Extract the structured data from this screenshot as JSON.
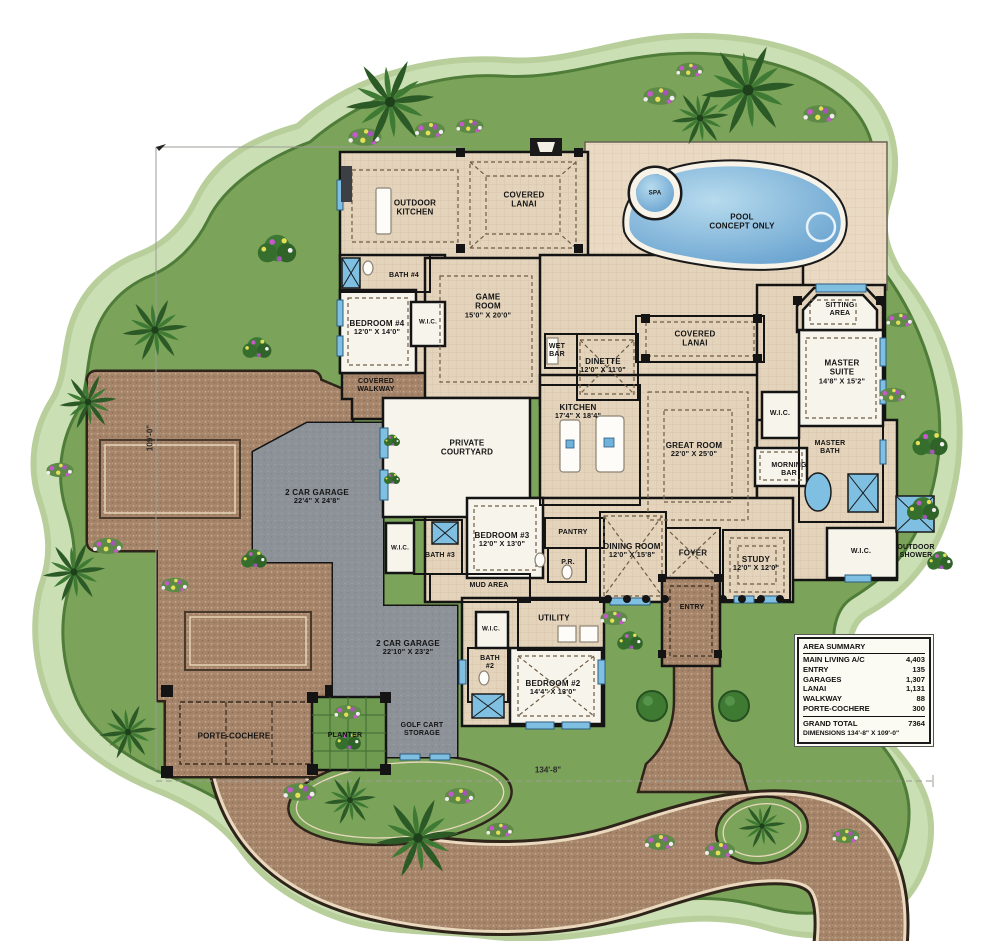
{
  "plan": {
    "type": "luxury-house-floor-plan",
    "colors": {
      "lawn": "#7ba45a",
      "lawn_edge": "#4f7c39",
      "lawn_halo": "#cbdfb4",
      "paver": "#a5846a",
      "room_tan": "#e4d4bc",
      "deck_tan": "#ead9c3",
      "garage_gray": "#8d9298",
      "pool_blue": "#5e9bcb",
      "window_blue": "#7fc0e2",
      "wall": "#141414"
    }
  },
  "rooms": {
    "outdoor_kitchen": {
      "l1": "OUTDOOR",
      "l2": "KITCHEN"
    },
    "covered_lanai_top": {
      "l1": "COVERED",
      "l2": "LANAI"
    },
    "spa": {
      "l1": "SPA"
    },
    "pool": {
      "l1": "POOL",
      "l2": "CONCEPT ONLY"
    },
    "bath4": {
      "l1": "BATH #4"
    },
    "bedroom4": {
      "l1": "BEDROOM #4",
      "dims": "12'0\" X 14'0\""
    },
    "wic4": {
      "l1": "W.I.C."
    },
    "game_room": {
      "l1": "GAME",
      "l2": "ROOM",
      "dims": "15'0\" X 20'0\""
    },
    "wet_bar": {
      "l1": "WET",
      "l2": "BAR"
    },
    "dinette": {
      "l1": "DINETTE",
      "dims": "12'0\" X 11'0\""
    },
    "covered_lanai_mid": {
      "l1": "COVERED",
      "l2": "LANAI"
    },
    "sitting_area": {
      "l1": "SITTING",
      "l2": "AREA"
    },
    "master_suite": {
      "l1": "MASTER",
      "l2": "SUITE",
      "dims": "14'8\" X 15'2\""
    },
    "wic_master": {
      "l1": "W.I.C."
    },
    "master_bath": {
      "l1": "MASTER",
      "l2": "BATH"
    },
    "morning_bar": {
      "l1": "MORNING",
      "l2": "BAR"
    },
    "covered_walkway": {
      "l1": "COVERED",
      "l2": "WALKWAY"
    },
    "kitchen": {
      "l1": "KITCHEN",
      "dims": "17'4\" X 18'4\""
    },
    "courtyard": {
      "l1": "PRIVATE",
      "l2": "COURTYARD"
    },
    "great_room": {
      "l1": "GREAT ROOM",
      "dims": "22'0\" X 25'0\""
    },
    "garage1": {
      "l1": "2 CAR GARAGE",
      "dims": "22'4\" X 24'8\""
    },
    "wic3": {
      "l1": "W.I.C."
    },
    "bath3": {
      "l1": "BATH #3"
    },
    "bedroom3": {
      "l1": "BEDROOM #3",
      "dims": "12'0\" X 13'0\""
    },
    "mud_area": {
      "l1": "MUD AREA"
    },
    "pantry": {
      "l1": "PANTRY"
    },
    "powder": {
      "l1": "P.R."
    },
    "dining": {
      "l1": "DINING ROOM",
      "dims": "12'0\" X 15'8\""
    },
    "foyer": {
      "l1": "FOYER"
    },
    "study": {
      "l1": "STUDY",
      "dims": "12'0\" X 12'0\""
    },
    "wic_master2": {
      "l1": "W.I.C."
    },
    "outdoor_shower": {
      "l1": "OUTDOOR",
      "l2": "SHOWER"
    },
    "entry": {
      "l1": "ENTRY"
    },
    "garage2": {
      "l1": "2 CAR GARAGE",
      "dims": "22'10\" X 23'2\""
    },
    "golf_cart": {
      "l1": "GOLF CART",
      "l2": "STORAGE"
    },
    "utility": {
      "l1": "UTILITY"
    },
    "wic2": {
      "l1": "W.I.C."
    },
    "bath2": {
      "l1": "BATH",
      "l2": "#2"
    },
    "bedroom2": {
      "l1": "BEDROOM #2",
      "dims": "14'4\" X 13'0\""
    },
    "porte_cochere": {
      "l1": "PORTE-COCHERE"
    },
    "planter": {
      "l1": "PLANTER"
    }
  },
  "site_dimensions": {
    "width": "134'-8\"",
    "height": "109'-0\""
  },
  "area_summary": {
    "title": "AREA SUMMARY",
    "rows": [
      {
        "label": "MAIN LIVING A/C",
        "value": "4,403"
      },
      {
        "label": "ENTRY",
        "value": "135"
      },
      {
        "label": "GARAGES",
        "value": "1,307"
      },
      {
        "label": "LANAI",
        "value": "1,131"
      },
      {
        "label": "WALKWAY",
        "value": "88"
      },
      {
        "label": "PORTE-COCHERE",
        "value": "300"
      }
    ],
    "total_label": "GRAND TOTAL",
    "total_value": "7364",
    "dimensions_label": "DIMENSIONS 134'-8\" X 109'-0\""
  }
}
